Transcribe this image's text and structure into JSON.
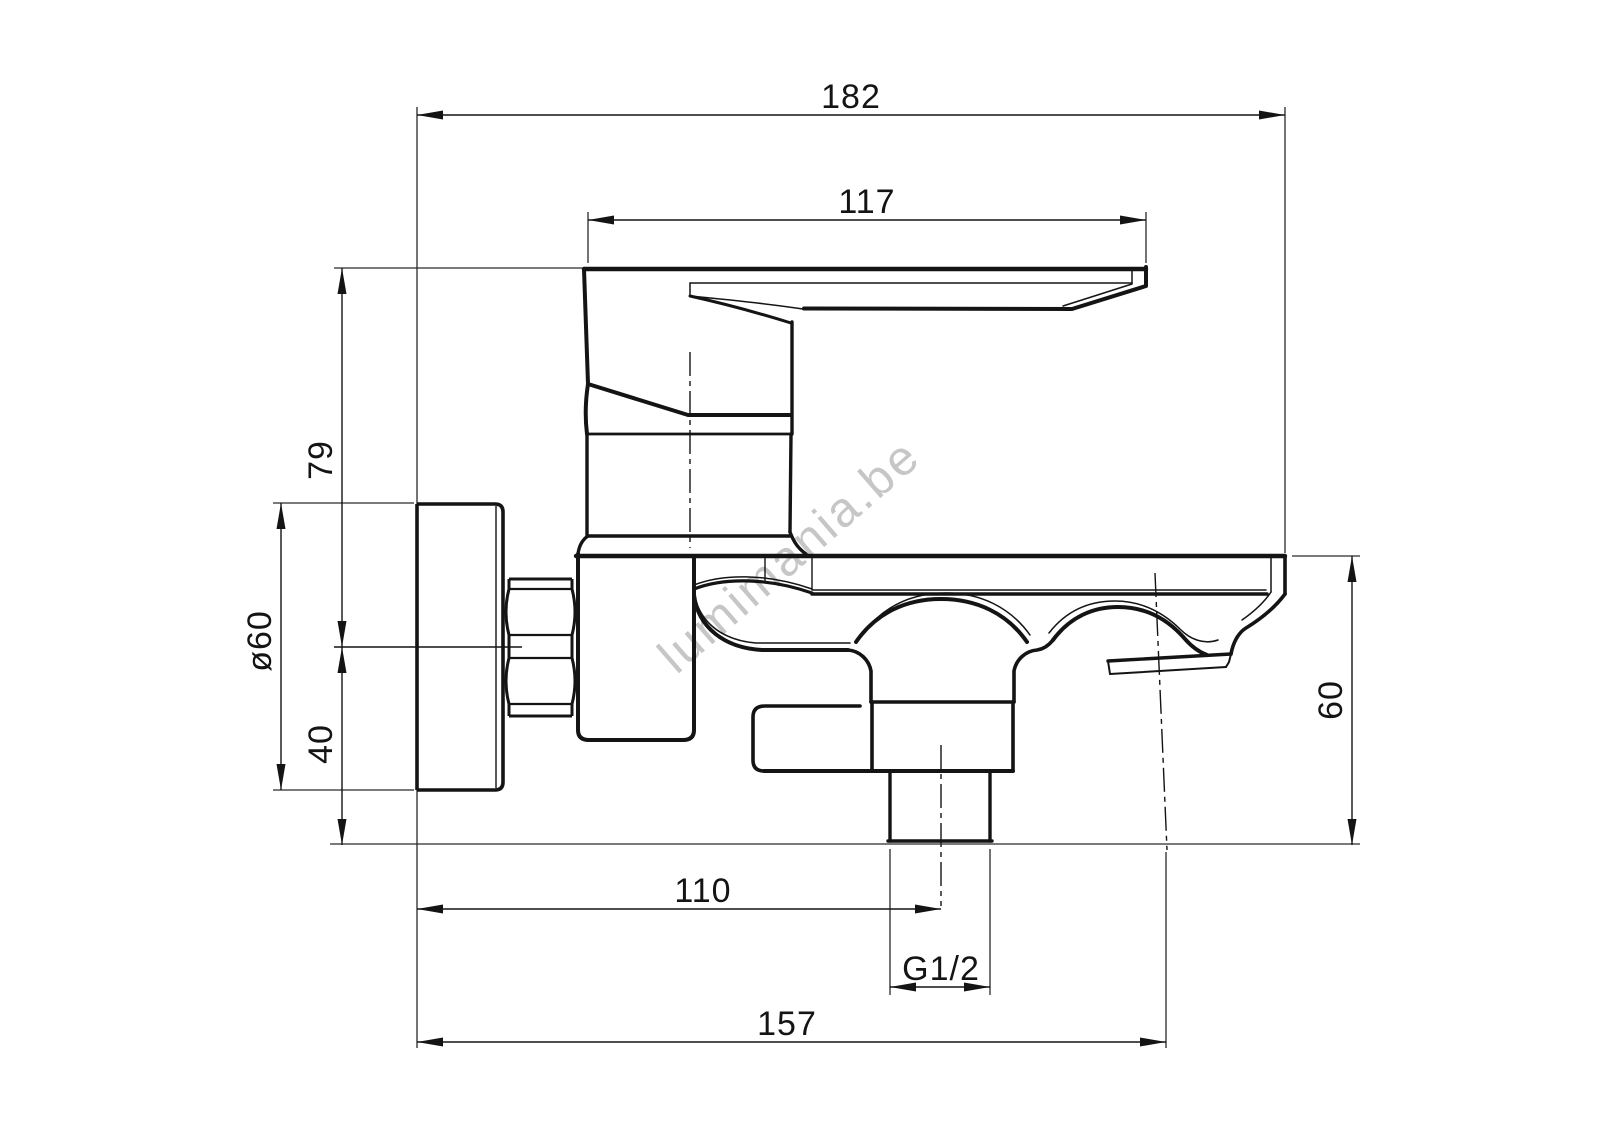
{
  "drawing": {
    "type": "technical-dimension-drawing",
    "subject": "wall-mounted single-lever bath mixer tap, side view",
    "units": "mm",
    "dimensions": {
      "overall_depth": "182",
      "lever_length": "117",
      "lever_height_above_axis": "79",
      "flange_diameter": "ø60",
      "axis_to_body_bottom": "40",
      "deck_to_outlet_bottom": "60",
      "wall_to_shower_outlet": "110",
      "shower_outlet_thread": "G1/2",
      "wall_to_spout_axis": "157"
    },
    "watermark": "lumimania.be",
    "colors": {
      "line": "#141414",
      "background": "#ffffff",
      "watermark": "#c6c6c6"
    }
  }
}
